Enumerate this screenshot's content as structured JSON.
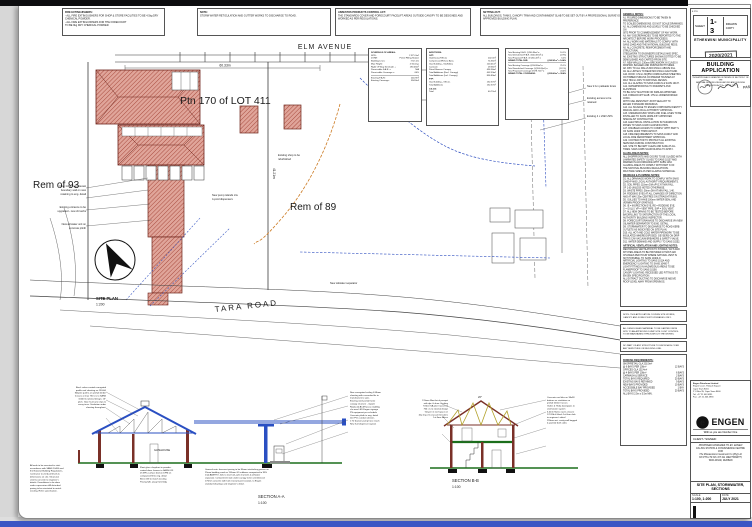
{
  "top_notes": [
    {
      "title": "FIRE EXTINGUISHERS:",
      "lines": [
        "- ALL FIRE EXTINGUISHERS FOR SHOP & STORE FACILITIES TO BE 4.5kg DRY CHEMICAL POWDER.",
        "- ALL FIRE EXTINGUISHERS FOR THE FORECOURT",
        "TO BE 9kg DRY CHEMICAL POWDER."
      ]
    },
    {
      "title": "NOTE:",
      "lines": [
        "STORM WATER RETICULATION AND GUTTER WORKS TO DISCHARGE TO ROAD."
      ]
    },
    {
      "title": "ASBESTOS PRODUCTS CONTROL ACT:",
      "lines": [
        "THE STANDARDS COVER AND FORECOURT FACELIFT AREAS OUTSIDE CANOPY TO BE DESIGNED AND WORKED AS PER REGULATIONS."
      ]
    },
    {
      "title": "SETTING-OUT:",
      "lines": [
        "ALL BUILDINGS, TANKS, CANOPY TRIM AND CONTAINMENT SLAB TO BE SET OUT BY A PROFESSIONAL SURVEYOR AS PER THE ENGEN APPROVED BUILDING PLAN."
      ]
    }
  ],
  "plan": {
    "labels": {
      "elm_avenue": "ELM AVENUE",
      "elm_dim": "60.33m",
      "ptn": "Ptn 170 of LOT 411",
      "rem93": "Rem of 93",
      "rem89": "Rem of 89",
      "tara_road": "TARA ROAD",
      "site_plan": "SITE PLAN",
      "site_scale": "1:200",
      "right_dim": "41.21m"
    },
    "stubs": [
      "New 1.8m high precast",
      "boundary wall on new",
      "retaining to eng. detail",
      "Existing entrance to be",
      "upgraded - new cb kerbs",
      "New air/water unit on",
      "concrete plinth",
      "New 2.1m palisade fence",
      "Existing access to be",
      "retained",
      "Existing 4 x 23kl USTs",
      "New pump islands c/w",
      "4-prod dispensers",
      "Existing shop to be",
      "refurbished",
      "New oil/water separator"
    ]
  },
  "schedule": {
    "areas": {
      "title": "SCHEDULE OF AREAS:",
      "rows": [
        [
          "SITE:",
          "2 371.2m²"
        ],
        [
          "ZONE:",
          "Petrol Filling Station"
        ],
        [
          "Building Lines:",
          "7.5m 2m"
        ],
        [
          "Max Height:",
          "2 Storeys"
        ],
        [
          "Right Of Way Servitude +",
          "190.46m²"
        ],
        [
          "Permissible F.A.R. =",
          "N/A"
        ],
        [
          "Permissible Coverage =",
          "60%"
        ]
      ],
      "rows2": [
        [
          "Existing F.A.R.:",
          "240.9m²"
        ],
        [
          "Existing Coverage:",
          "594.8m²"
        ]
      ]
    },
    "additions": {
      "title": "ADDITIONS:",
      "g1": "GFT:",
      "g1_rows": [
        [
          "Gatehouse/Offices",
          "202.0m²"
        ],
        [
          "Compressor/Refuse Area",
          "74.56m²"
        ],
        [
          "Gas Building - Staff Area",
          "100.41m²"
        ],
        [
          "Carwash",
          "29.36m²"
        ],
        [
          "Petrol Bowser Canopy",
          "434.56m²"
        ],
        [
          "Total Additions (Excl. Canopy)",
          "402.33m²"
        ],
        [
          "Total Additions (Incl. Canopy)",
          "836.89m²"
        ]
      ],
      "g2": "FTP:",
      "g2_rows": [
        [
          "Gas Building - Offices",
          "152.37m²"
        ],
        [
          "Total Additions",
          "152.37m²"
        ]
      ],
      "g3": "CS-GS:",
      "g3_rows": [
        [
          "Total",
          "40.72m²"
        ]
      ]
    },
    "totals": {
      "rows": [
        [
          "Total Existing F.A.R. @240.90m² =",
          "10.1%"
        ],
        [
          "Total Demolished F.A.R. @(44.63m²) =",
          "(1.9%)"
        ],
        [
          "Total Proposed F.A.R. @146.14m² =",
          "6.2%"
        ]
      ],
      "grand1_label": "GRAND TOTAL FAR:",
      "grand1_value": "@342.41m² = 14.4%",
      "rows2": [
        [
          "Total Existing Coverage @594.80m² =",
          "25.1%"
        ],
        [
          "Total Demolished Coverage @(264.09m²) =",
          "(11.1%)"
        ],
        [
          "Total Proposed Coverage @578.72m² =",
          "24.4%"
        ]
      ],
      "grand2_label": "GRAND TOTAL COVERAGE:",
      "grand2_value": "@909.43m² = 38.4%"
    }
  },
  "notes_col": {
    "sections": [
      {
        "title": "GENERAL NOTES:",
        "lines": [
          "A1. FIGURED DIMENSIONS TO BE TAKEN IN PREFERENCE",
          "TO SCALED DIMENSIONS. DO NOT SCALE DRAWINGS.",
          "A2. ALL DIMENSIONS AND LEVELS TO BE CHECKED ON",
          "SITE PRIOR TO COMMENCEMENT OF ANY WORK.",
          "A3. ANY DISCREPANCIES TO BE REPORTED TO THE",
          "ARCHITECT BEFORE WORK PROCEEDS.",
          "A4. ALL WORK AND MATERIALS TO COMPLY WITH",
          "SANS 10400 AND THE NATIONAL BUILDING REGS.",
          "A5. ALL CONCRETE, REINFORCEMENT AND STRUCTURAL",
          "STEELWORK TO ENGINEER'S DETAILS AND SPEC.",
          "A6. EXISTING STRUCTURES SHOWN DOTTED TO BE",
          "DEMOLISHED AND CARTED FROM SITE.",
          "A7. NEW WALLS: 230mm BRICKWORK IN CLASS II",
          "MORTAR, BAGGED AND PAINTED BOTH SIDES.",
          "A8. DPC TO ALL WALLS MIN 150mm ABOVE FGL.",
          "A9. ALL LINTELS TO BEAR MIN 150mm EACH END.",
          "A10. ROOF: 0.5mm ISQ550 CORRUGATED SHEETING",
          "ON TIMBER PURLINS ON PREFAB TRUSSES AT",
          "MAX 760mm CRS TO RATIONAL DESIGN.",
          "A11. ALL GLAZING TO SANS 10400-N & SANS 10137.",
          "A12. WATERPROOFING TO PARAPETS AND FLASHINGS",
          "TO BE 3-PLY MALTHOID OR SIMILAR APPROVED.",
          "A13. FORECOURT SLAB: 175mm UNREINFORCED CONC.",
          "WITH FUEL RESISTANT JOINT SEALANT TO",
          "ENGEN STANDARD DRAWINGS.",
          "A14. ALL SIGNAGE TO ENGEN CORPORATE IDENTITY",
          "MANUAL AND LOCAL AUTHORITY APPROVAL.",
          "A15. UNDERGROUND TANKS AND FUEL LINES TO BE",
          "INSTALLED TO SANS 10089-3 BY APPROVED",
          "SPECIALIST CONTRACTOR.",
          "A16. ELECTRICAL INSTALLATION IN HAZARDOUS",
          "ZONES TO SANS 10108 CLASSIFICATION.",
          "A17. DISABLED ACCESS TO COMPLY WITH PART S",
          "OF SANS 10400 THROUGHOUT.",
          "A18. FIRE REQUIREMENTS TO SANS 10400-T AND",
          "LOCAL FIRE DEPARTMENT APPROVAL.",
          "A19. CONTRACTOR TO PROTECT ALL EXISTING",
          "SERVICES DURING CONSTRUCTION.",
          "A20. SITE TO BE KEPT CLEAN AND SAFE AT ALL",
          "TIMES. SANS 10085 SCAFFOLDING TO APPLY."
        ]
      },
      {
        "title": "GLASS AREAS NOTES:",
        "lines": [
          "ALL SHOPFRONTS AND DOORS TO BE GLAZED WITH",
          "LAMINATED SAFETY GLASS TO SANS 10137 AND",
          "MARKED IN ACCORDANCE WITH SABS 1263.",
          "GLAZING AREAS TO COMPLY WITH PART N OF",
          "THE NATIONAL BUILDING REGULATIONS.",
          "MAX PANE SIZES AS PER GLAZING SCHEDULE."
        ]
      },
      {
        "title": "DRAINAGE & PLUMBING NOTES:",
        "lines": [
          "D1. ALL DRAINAGE WORK TO COMPLY WITH SANS",
          "10400-P AND LOCAL AUTHORITY REQUIREMENTS.",
          "D2. SOIL PIPES: 110mm DIA uPVC AT MIN FALL",
          "OF 1:60 UNLESS NOTED OTHERWISE.",
          "D3. WASTE PIPES: 50mm DIA AT MIN FALL 1:40.",
          "D4. RODDING EYES AT ALL CHANGES OF DIRECTION",
          "AND AT MAX 25m CENTRES ON STRAIGHT RUNS.",
          "D5. GULLIES TO HAVE 100mm WATER SEAL AND",
          "VERMIN PROOF GRATINGS.",
          "D6. IE = INSPECTION EYE, RE = RODDING EYE,",
          "G = GULLY, VP = VENT PIPE, SVP = SOIL VENT.",
          "D7. ALL NEW DRAINS TO BE TESTED BEFORE",
          "BACKFILLING TO SATISFACTION OF THE LOCAL",
          "AUTHORITY BUILDING INSPECTOR.",
          "D8. FORECOURT DRAINAGE TO DISCHARGE VIA NEW",
          "OIL/WATER SEPARATOR TO ENG. DETAIL.",
          "D9. STORMWATER TO DISCHARGE TO ROAD KERB",
          "OUTLETS AS INDICATED ON SITE PLAN.",
          "D10. ALL HOT AND COLD WATER PIPEWORK TO BE",
          "INSULATED WHERE EXPOSED. GEYSERS ON DRIP",
          "TRAYS C/W VACUUM BREAKERS & SAFETY VALVE.",
          "D11. WATER DEMAND AND SUPPLY TO SANS 10252."
        ]
      },
      {
        "title": "ARTIFICIAL VENTILATION AND LIGHTING NOTES:",
        "lines": [
          "MECHANICAL VENTILATION TO STORES, WC'S AND",
          "KITCHEN AREAS TO BE PROVIDED AT MIN 5 AIR",
          "CHANGES PER HOUR WHERE NATURAL VENT IS",
          "NOT POSSIBLE, TO SANS 10400-O.",
          "ARTIFICIAL LIGHTING TO SANS 10114 AND",
          "EMERGENCY LIGHTING TO SANS 10400-T.",
          "LIGHT FITTINGS IN HAZARDOUS AREAS TO BE",
          "FLAMEPROOF TO SANS 10108.",
          "CANOPY LIGHTING: RECESSED LED FITTINGS TO",
          "ENGEN SPECIFICATION.",
          "ALL EXTRACT DUCTING TO DISCHARGE ABOVE",
          "ROOF LEVEL AWAY FROM OPENINGS."
        ]
      }
    ],
    "boxes": [
      {
        "lines": [
          "NOTE: THIS APPLICATION COVERS SITE WORKS,",
          "CANOPY AND FORECOURT UPGRADES ONLY."
        ]
      },
      {
        "lines": [
          "ALL DEMOLISHED MATERIAL TO BE CARTED FROM",
          "SITE TO AN APPROVED DUMP SITE. DUST CONTROL",
          "TO BE MAINTAINED THROUGHOUT THE WORKS."
        ]
      },
      {
        "lines": [
          "NO PART OF ANY STRUCTURE TO ENCROACH OVER",
          "ANY SERVITUDE OR BUILDING LINE."
        ]
      }
    ],
    "parking": {
      "title": "PARKING REQUIREMENTS:",
      "rows": [
        [
          "SHOP/RETAIL GLA 202.0m²",
          ""
        ],
        [
          "@ 6 BAYS PER 100m²",
          "12 BAYS"
        ],
        [
          "OFFICES GLA 152.4m²",
          ""
        ],
        [
          "@ 4 BAYS PER 100m²",
          "6 BAYS"
        ],
        [
          "CARWASH & SERVICE",
          "2 BAYS"
        ],
        [
          "TOTAL BAYS REQUIRED",
          "20 BAYS"
        ],
        [
          "EXISTING BAYS RETAINED",
          "9 BAYS"
        ],
        [
          "NEW BAYS PROVIDED",
          "10 BAYS"
        ],
        [
          "ACCESSIBLE BAY PROVIDED",
          "1 BAY"
        ],
        [
          "TOTAL BAYS PROVIDED",
          "20 BAYS"
        ],
        [
          "ALL BAYS 2.5m x 5.5m MIN.",
          ""
        ]
      ]
    }
  },
  "title_block": {
    "sheet_box": {
      "corner": "E 27/9",
      "sheet_label": "SHEET",
      "sheet_no": "1-3",
      "copy": "DRAWN COPY",
      "municipality": "ETHEKWINI MUNICIPALITY",
      "stamp_date": "2020/2021",
      "app_number": "APPLICATION NUMBER"
    },
    "approval": {
      "title": "BUILDING APPLICATION",
      "subs": [
        "THIS APPROVAL IS GRANTED IN TERMS OF SECTION 7 OF THE",
        "NATIONAL BUILDING REGULATIONS AND BUILDING",
        "STANDARDS ACT No 103 OF 1977"
      ],
      "passed": "PASSED",
      "fine": [
        "APPROVAL LAPSES IF WORK HAS NOT COMMENCED WITHIN 12 MONTHS OF DATE",
        "OF APPROVAL. ALL WORK IS SUBJECT TO INSPECTION BY THE AUTHORITY.",
        "THIS APPROVED PLAN MUST BE KEPT ON SITE AT ALL TIMES."
      ]
    },
    "firm": {
      "name": "Engen Petroleum Limited",
      "addr": [
        "Engen Court, Thibault Square",
        "Cape Town 8001",
        "P O Box 35, Cape Town 8000",
        "Tel:  +27 21 403 4911",
        "Fax:  +27 21 403 4990"
      ],
      "logo": "ENGEN",
      "logo_e": "e",
      "tagline": "With us you are Number One",
      "client_label": "CLIENT / SIGNED:"
    },
    "project": {
      "lines": [
        "PROPOSED UPGRADES TO EX. ENGEN",
        "FILLING STATION & CONVENIENCE CENTRE",
        "FOR",
        "The Mineworkers Investment Co (Pty) Ltd",
        "ON PTN 170 OF LOT 411 WENTWORTH,",
        "TARA ROAD, DURBAN"
      ],
      "drawing_title": "SITE PLAN, STORMWATER, SECTIONS"
    },
    "fields": [
      {
        "label": "SCALE",
        "value": "1:100, 1:200"
      },
      {
        "label": "DATE",
        "value": "JULY 2021"
      }
    ],
    "bottom": [
      {
        "label": "JOB No",
        "value": "2022"
      },
      {
        "label": "DWG No",
        "value": "01"
      },
      {
        "label": "REV",
        "value": "B"
      }
    ]
  },
  "sections_area": {
    "a_label": "SECTION A-A",
    "a_scale": "1:100",
    "b_label": "SECTION B-B",
    "b_scale": "1:100",
    "room": "GATEHOUSE",
    "apex_b": "26°",
    "clusters": {
      "secTL": [
        "Roof: colour coated corrugated",
        "profile roof sheeting on 152x50",
        "SA pine purlins on prefab timber",
        "trusses at max 760 crs to SANS",
        "10243 & rational design. 15°",
        "pitch. Galv. hurricane clips to",
        "every truss. Sisalation under",
        "sheeting throughout."
      ],
      "canopy_right": [
        "New corrugated ceiling 0.58mm",
        "sheeting with concealed fix to",
        "manufacturers spec.",
        "Existing steel portal frame",
        "canopy structure - repaint",
        "Replaced ACM fascia cladding",
        "c/w new LED Engen signage",
        "PS equipment per schedule",
        "Concrete plinth to eng. detail",
        "110 PVC conduit sleeves",
        "1:70 bowser pump hose reach",
        "New fuel dispenser 4-prod."
      ],
      "secA_below": [
        "Float glass shopfront in powder-",
        "coated alum. frames to SANS 613",
        "25 MPa surface bed on DPM on",
        "compacted fill to eng. detail",
        "Brick infill to match existing",
        "Paving falls away from bldg"
      ],
      "blockBL": [
        "All work to be executed in strict",
        "accordance with SANS 10400 and",
        "the National Building Regulations.",
        "Contractor to verify all levels &",
        "dimensions on site. Structural",
        "steel & concrete to engineer's",
        "details. Demolitions to be done",
        "under supervision. All disturbed",
        "paving to be reinstated to match",
        "existing. Refer specification."
      ],
      "paving": [
        "General note: forecourt paving to be 80mm interlocking pavers on",
        "25mm bedding sand on 150mm G5 subbase compacted to 95%",
        "mod AASHTO, falls to new fuel-safe channels & oil/water",
        "separator. Containment slab under canopy to be unreinforced",
        "175mm concrete with fuel resistant joint sealant, to Engen",
        "standard drawings and engineer's detail."
      ],
      "secB_left": [
        "115mm Maxi brick parapet",
        "with dpc & alum. flashing",
        "Timber SA pine trusses at",
        "760 crs to rational design",
        "Geyser in roof space on",
        "drip tray c/w vacuum breakers",
        "1st floor offices"
      ],
      "secB_right": [
        "Concrete roof tiles on 38x38",
        "battens on sisalation on",
        "prefab timber trusses",
        "Gutter & 75dia downpipes to",
        "stormwater system",
        "6.4mm Nutec eaves closure",
        "170 Rib & block 1st floor slab",
        "to engineer's detail",
        "255mm ext. cavity wall bagged",
        "& painted both sides"
      ]
    }
  }
}
